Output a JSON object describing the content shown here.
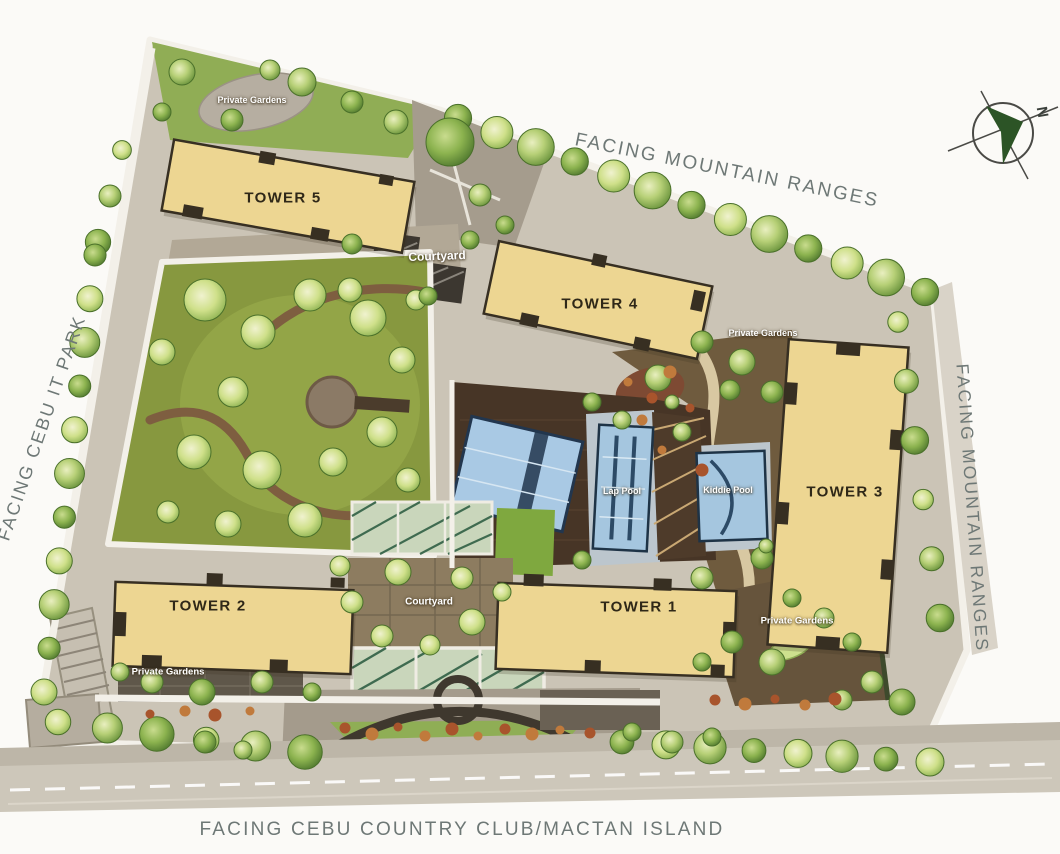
{
  "plan_title": "site-development-plan",
  "labels": {
    "facing_top": "FACING MOUNTAIN RANGES",
    "facing_right": "FACING MOUNTAIN RANGES",
    "facing_left": "FACING CEBU IT PARK",
    "facing_bottom": "FACING CEBU COUNTRY CLUB/MACTAN ISLAND"
  },
  "compass": {
    "north_letter": "N"
  },
  "towers": [
    {
      "label": "TOWER 1"
    },
    {
      "label": "TOWER 2"
    },
    {
      "label": "TOWER 3"
    },
    {
      "label": "TOWER 4"
    },
    {
      "label": "TOWER 5"
    }
  ],
  "amenities": {
    "courtyard_north": "Courtyard",
    "courtyard_south": "Courtyard",
    "lap_pool": "Lap Pool",
    "kiddie_pool": "Kiddie Pool"
  },
  "private_gardens": {
    "northwest": "Private Gardens",
    "east": "Private Gardens",
    "southwest": "Private Gardens",
    "southeast": "Private Gardens"
  },
  "colors": {
    "building": "#EDD692",
    "building_outline": "#372F22",
    "lawn": "#87983F",
    "tree_light": "#CFE08A",
    "tree_dark": "#5E8A33",
    "pool_water": "#A5C6DF",
    "deck_brown": "#473526",
    "path_gray": "#CBC4B6",
    "label_gray": "#6E7876",
    "compass_green": "#2C5426"
  }
}
